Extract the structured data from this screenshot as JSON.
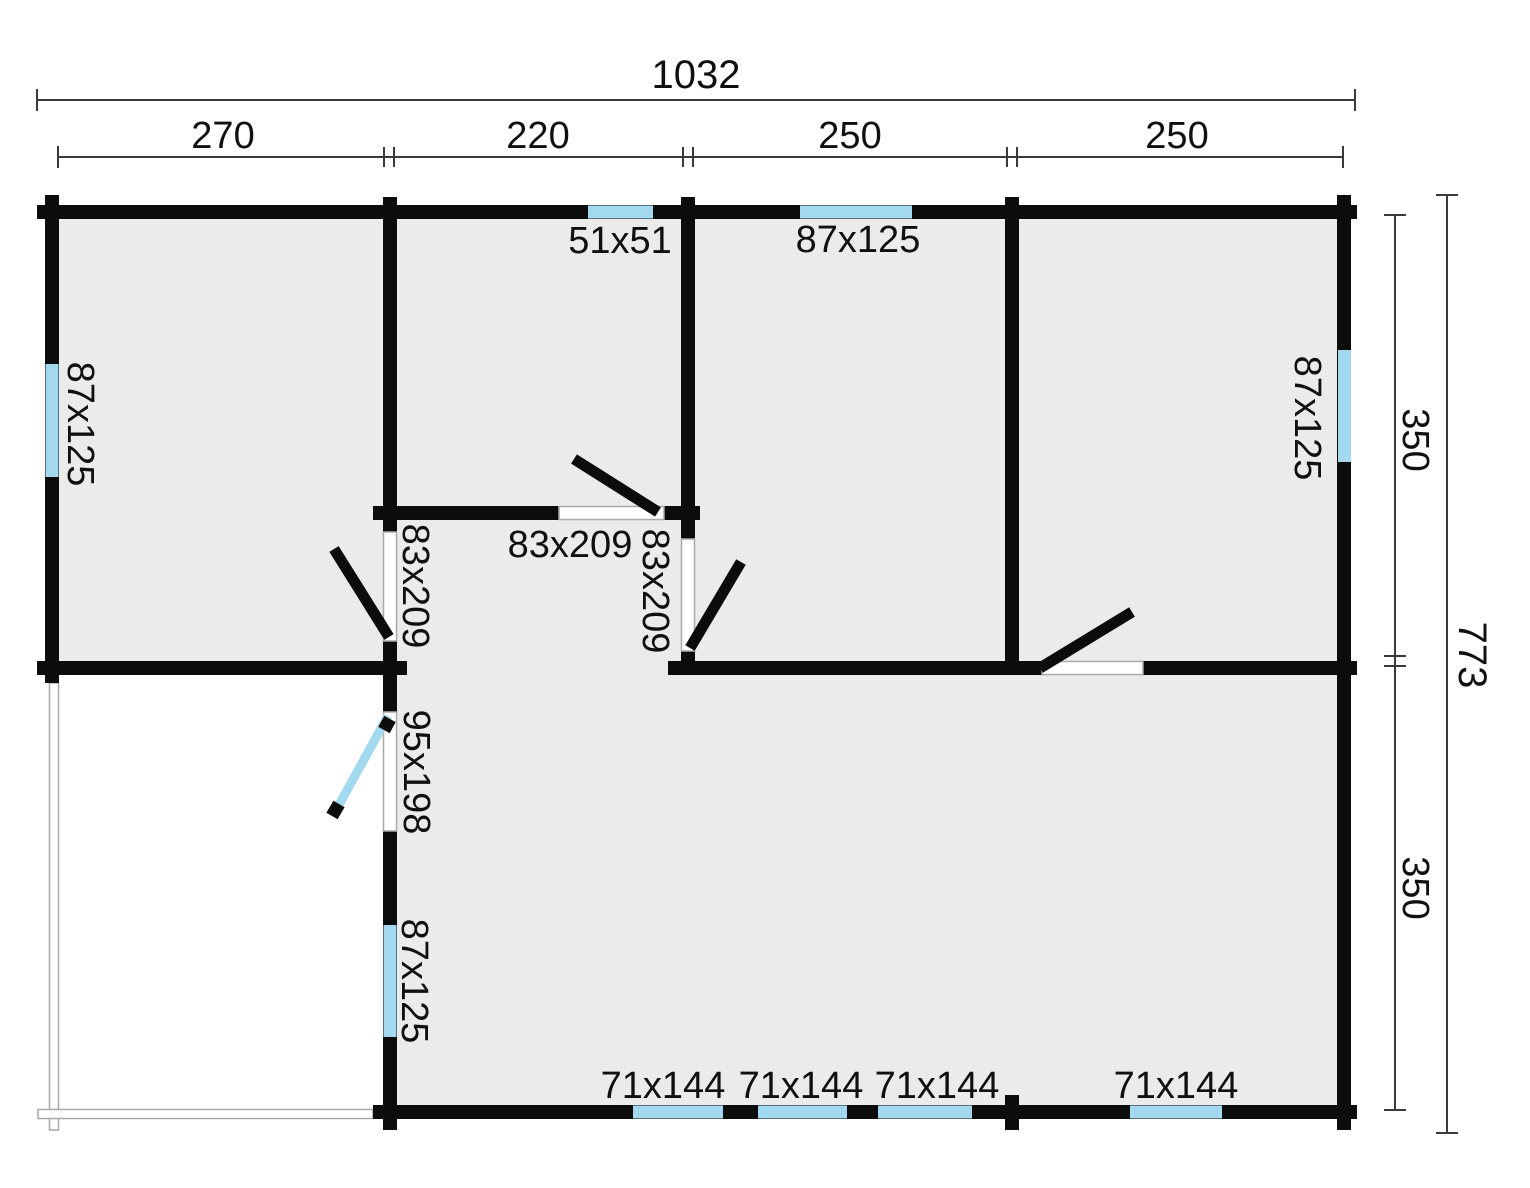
{
  "title": "Floor plan",
  "colors": {
    "wall": "#0c0c0c",
    "room_fill": "#ebebeb",
    "window_blue": "#a3d9ee",
    "dim_line": "#3a3a3a",
    "thin_line": "#a9a9a9",
    "text": "#101010",
    "background": "#ffffff"
  },
  "dimensions": {
    "overall_width": "1032",
    "overall_height": "773",
    "top_segments": [
      "270",
      "220",
      "250",
      "250"
    ],
    "right_segments": [
      "350",
      "350"
    ]
  },
  "labels": {
    "overall_width": "1032",
    "overall_height": "773",
    "seg_270": "270",
    "seg_220": "220",
    "seg_250_a": "250",
    "seg_250_b": "250",
    "seg_350_upper": "350",
    "seg_350_lower": "350",
    "window_51": "51x51",
    "window_top_87": "87x125",
    "window_left_87": "87x125",
    "window_right_87": "87x125",
    "window_lowerleft_87": "87x125",
    "door_left_83": "83x209",
    "door_mid_83": "83x209",
    "door_right_83": "83x209",
    "door_glass_95": "95x198",
    "window_71_a": "71x144",
    "window_71_b": "71x144",
    "window_71_c": "71x144",
    "window_71_d": "71x144"
  }
}
